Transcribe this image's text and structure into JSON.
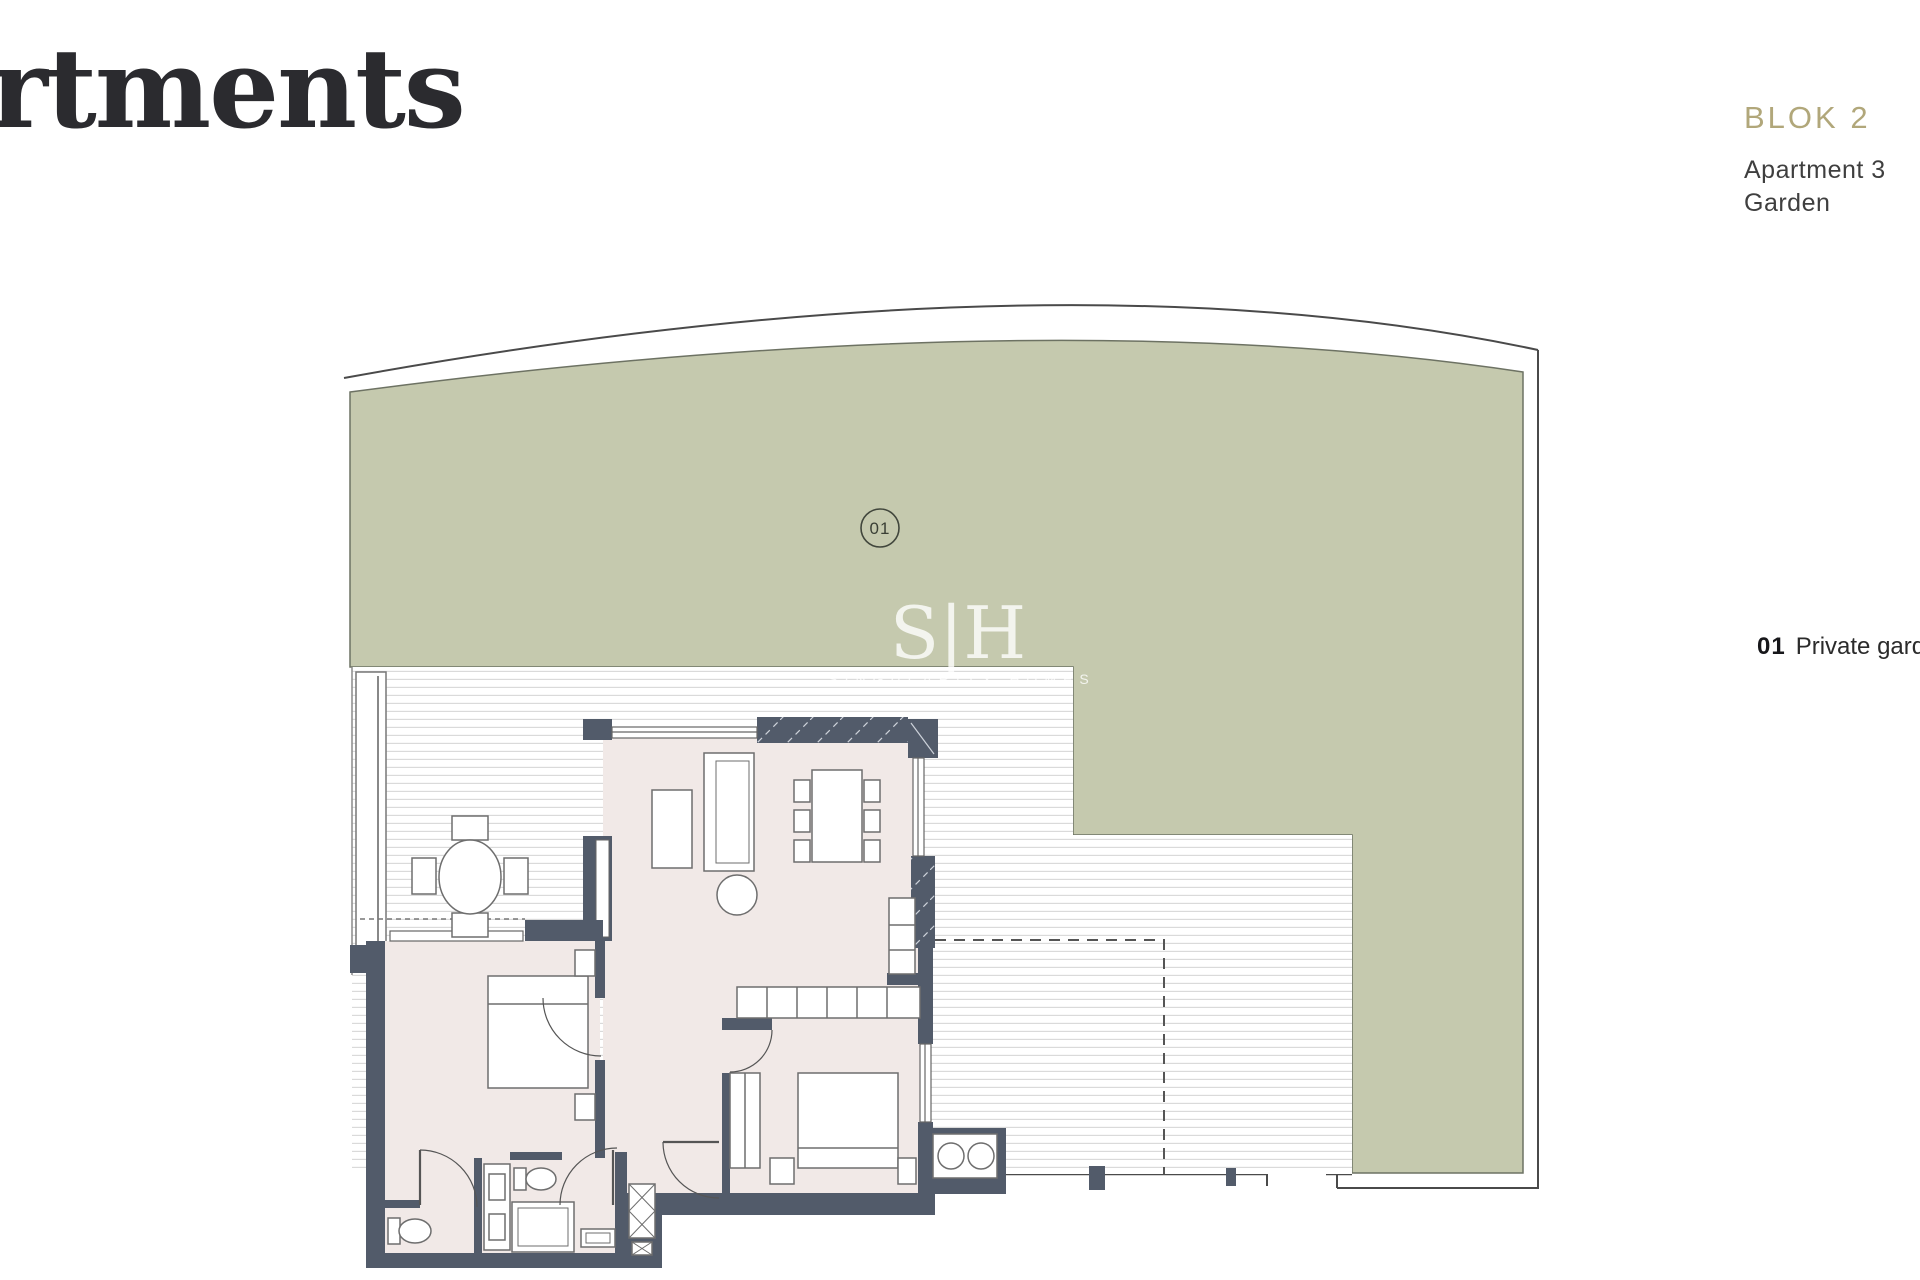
{
  "page": {
    "title_partial": "rtments"
  },
  "header": {
    "block_label": "BLOK 2",
    "apartment_label": "Apartment 3",
    "type_label": "Garden"
  },
  "legend": {
    "code": "01",
    "label": "Private garden"
  },
  "plan": {
    "garden_marker_code": "01",
    "watermark_initials": "S|H",
    "watermark_name": "SINGULARITY HOMES"
  },
  "colors": {
    "accent_gold": "#b1a77a",
    "garden_green": "#c5c9ae",
    "wall_slate": "#525b6a",
    "floor_pink": "#f1e9e7",
    "title_ink": "#2b2b2f",
    "text_dark": "#3f3f3f"
  }
}
